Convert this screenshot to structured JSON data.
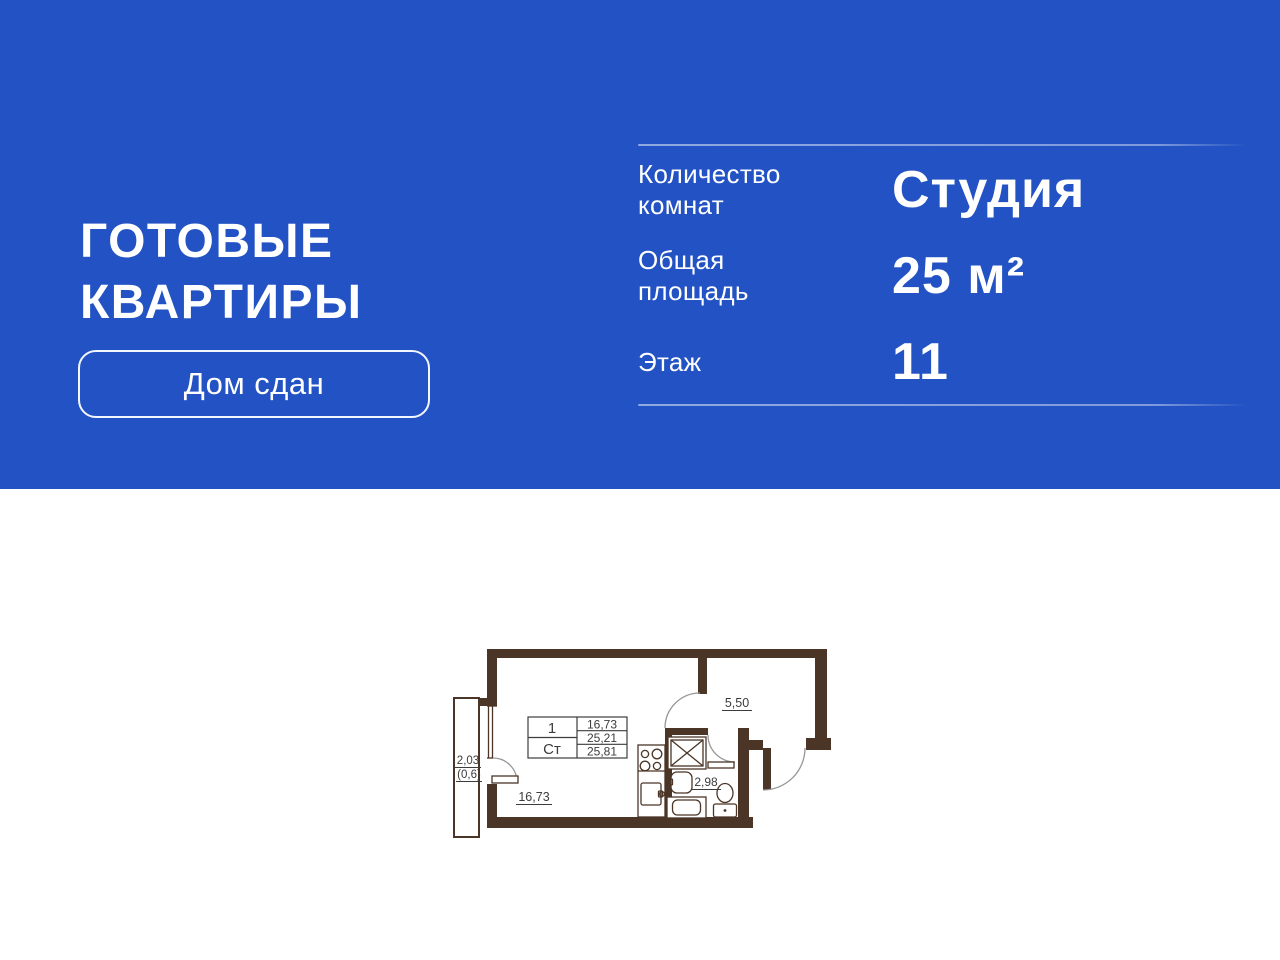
{
  "banner": {
    "bg_color": "#2252c3",
    "title": {
      "line1": "ГОТОВЫЕ",
      "line2": "КВАРТИРЫ"
    },
    "badge": {
      "label": "Дом сдан"
    },
    "specs": {
      "rows": [
        {
          "label": "Количество комнат",
          "value": "Студия"
        },
        {
          "label": "Общая площадь",
          "value": "25 м²"
        },
        {
          "label": "Этаж",
          "value": "11"
        }
      ]
    }
  },
  "floor_plan": {
    "colors": {
      "wall": "#4a3526",
      "line": "#3c3c3c",
      "arc": "#979797"
    },
    "stamp": {
      "left_rows": [
        "1",
        "Ст"
      ],
      "right_rows": [
        "16,73",
        "25,21",
        "25,81"
      ]
    },
    "labels": {
      "hall_area": "5,50",
      "room_area": "16,73",
      "bath_area": "2,98",
      "balcony_width": "2,03",
      "balcony_area": "(0,6)"
    }
  }
}
